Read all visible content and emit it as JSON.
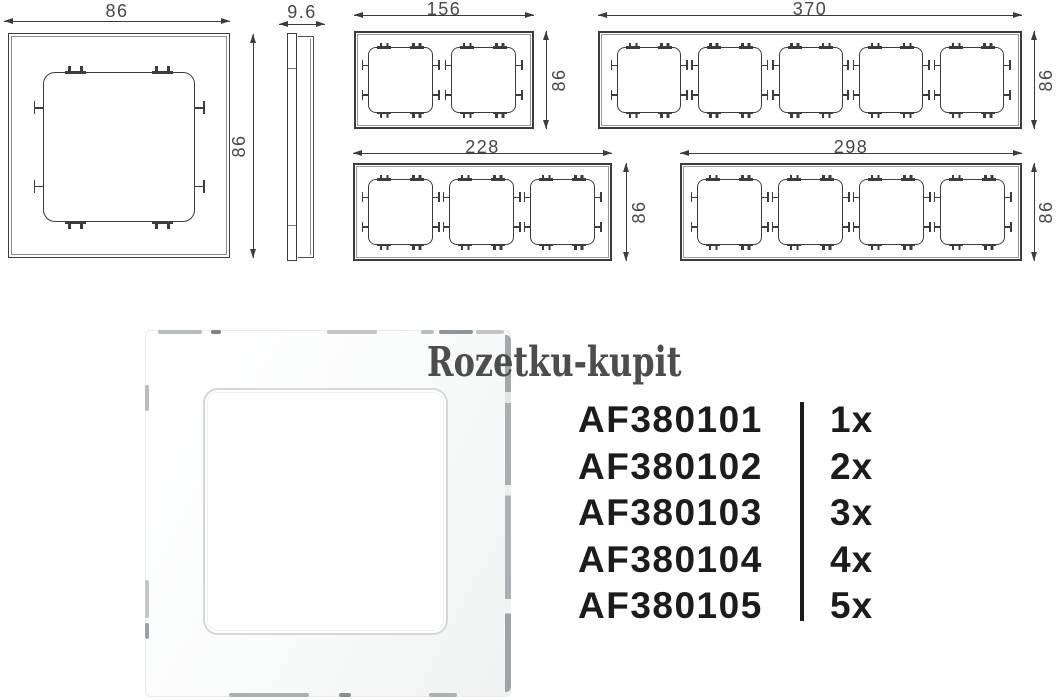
{
  "colors": {
    "line": "#3c3c3c",
    "dimension_text": "#474747",
    "product_text": "#1c1c1c",
    "watermark_text": "#4d4d4d",
    "divider": "#1c1c1c",
    "photo_frame": "#ffffff",
    "reflection_gray": "#a9aeb1"
  },
  "watermark": {
    "text": "Rozetku-kupit"
  },
  "drawings": {
    "single": {
      "gangs": 1,
      "width_label": "86",
      "height_label": "86"
    },
    "side": {
      "thickness_label": "9.6"
    },
    "gang2": {
      "gangs": 2,
      "width_label": "156",
      "height_label": "86"
    },
    "gang5": {
      "gangs": 5,
      "width_label": "370",
      "height_label": "86"
    },
    "gang3": {
      "gangs": 3,
      "width_label": "228",
      "height_label": "86"
    },
    "gang4": {
      "gangs": 4,
      "width_label": "298",
      "height_label": "86"
    }
  },
  "products": {
    "rows": [
      {
        "code": "AF380101",
        "qty": "1x"
      },
      {
        "code": "AF380102",
        "qty": "2x"
      },
      {
        "code": "AF380103",
        "qty": "3x"
      },
      {
        "code": "AF380104",
        "qty": "4x"
      },
      {
        "code": "AF380105",
        "qty": "5x"
      }
    ]
  }
}
